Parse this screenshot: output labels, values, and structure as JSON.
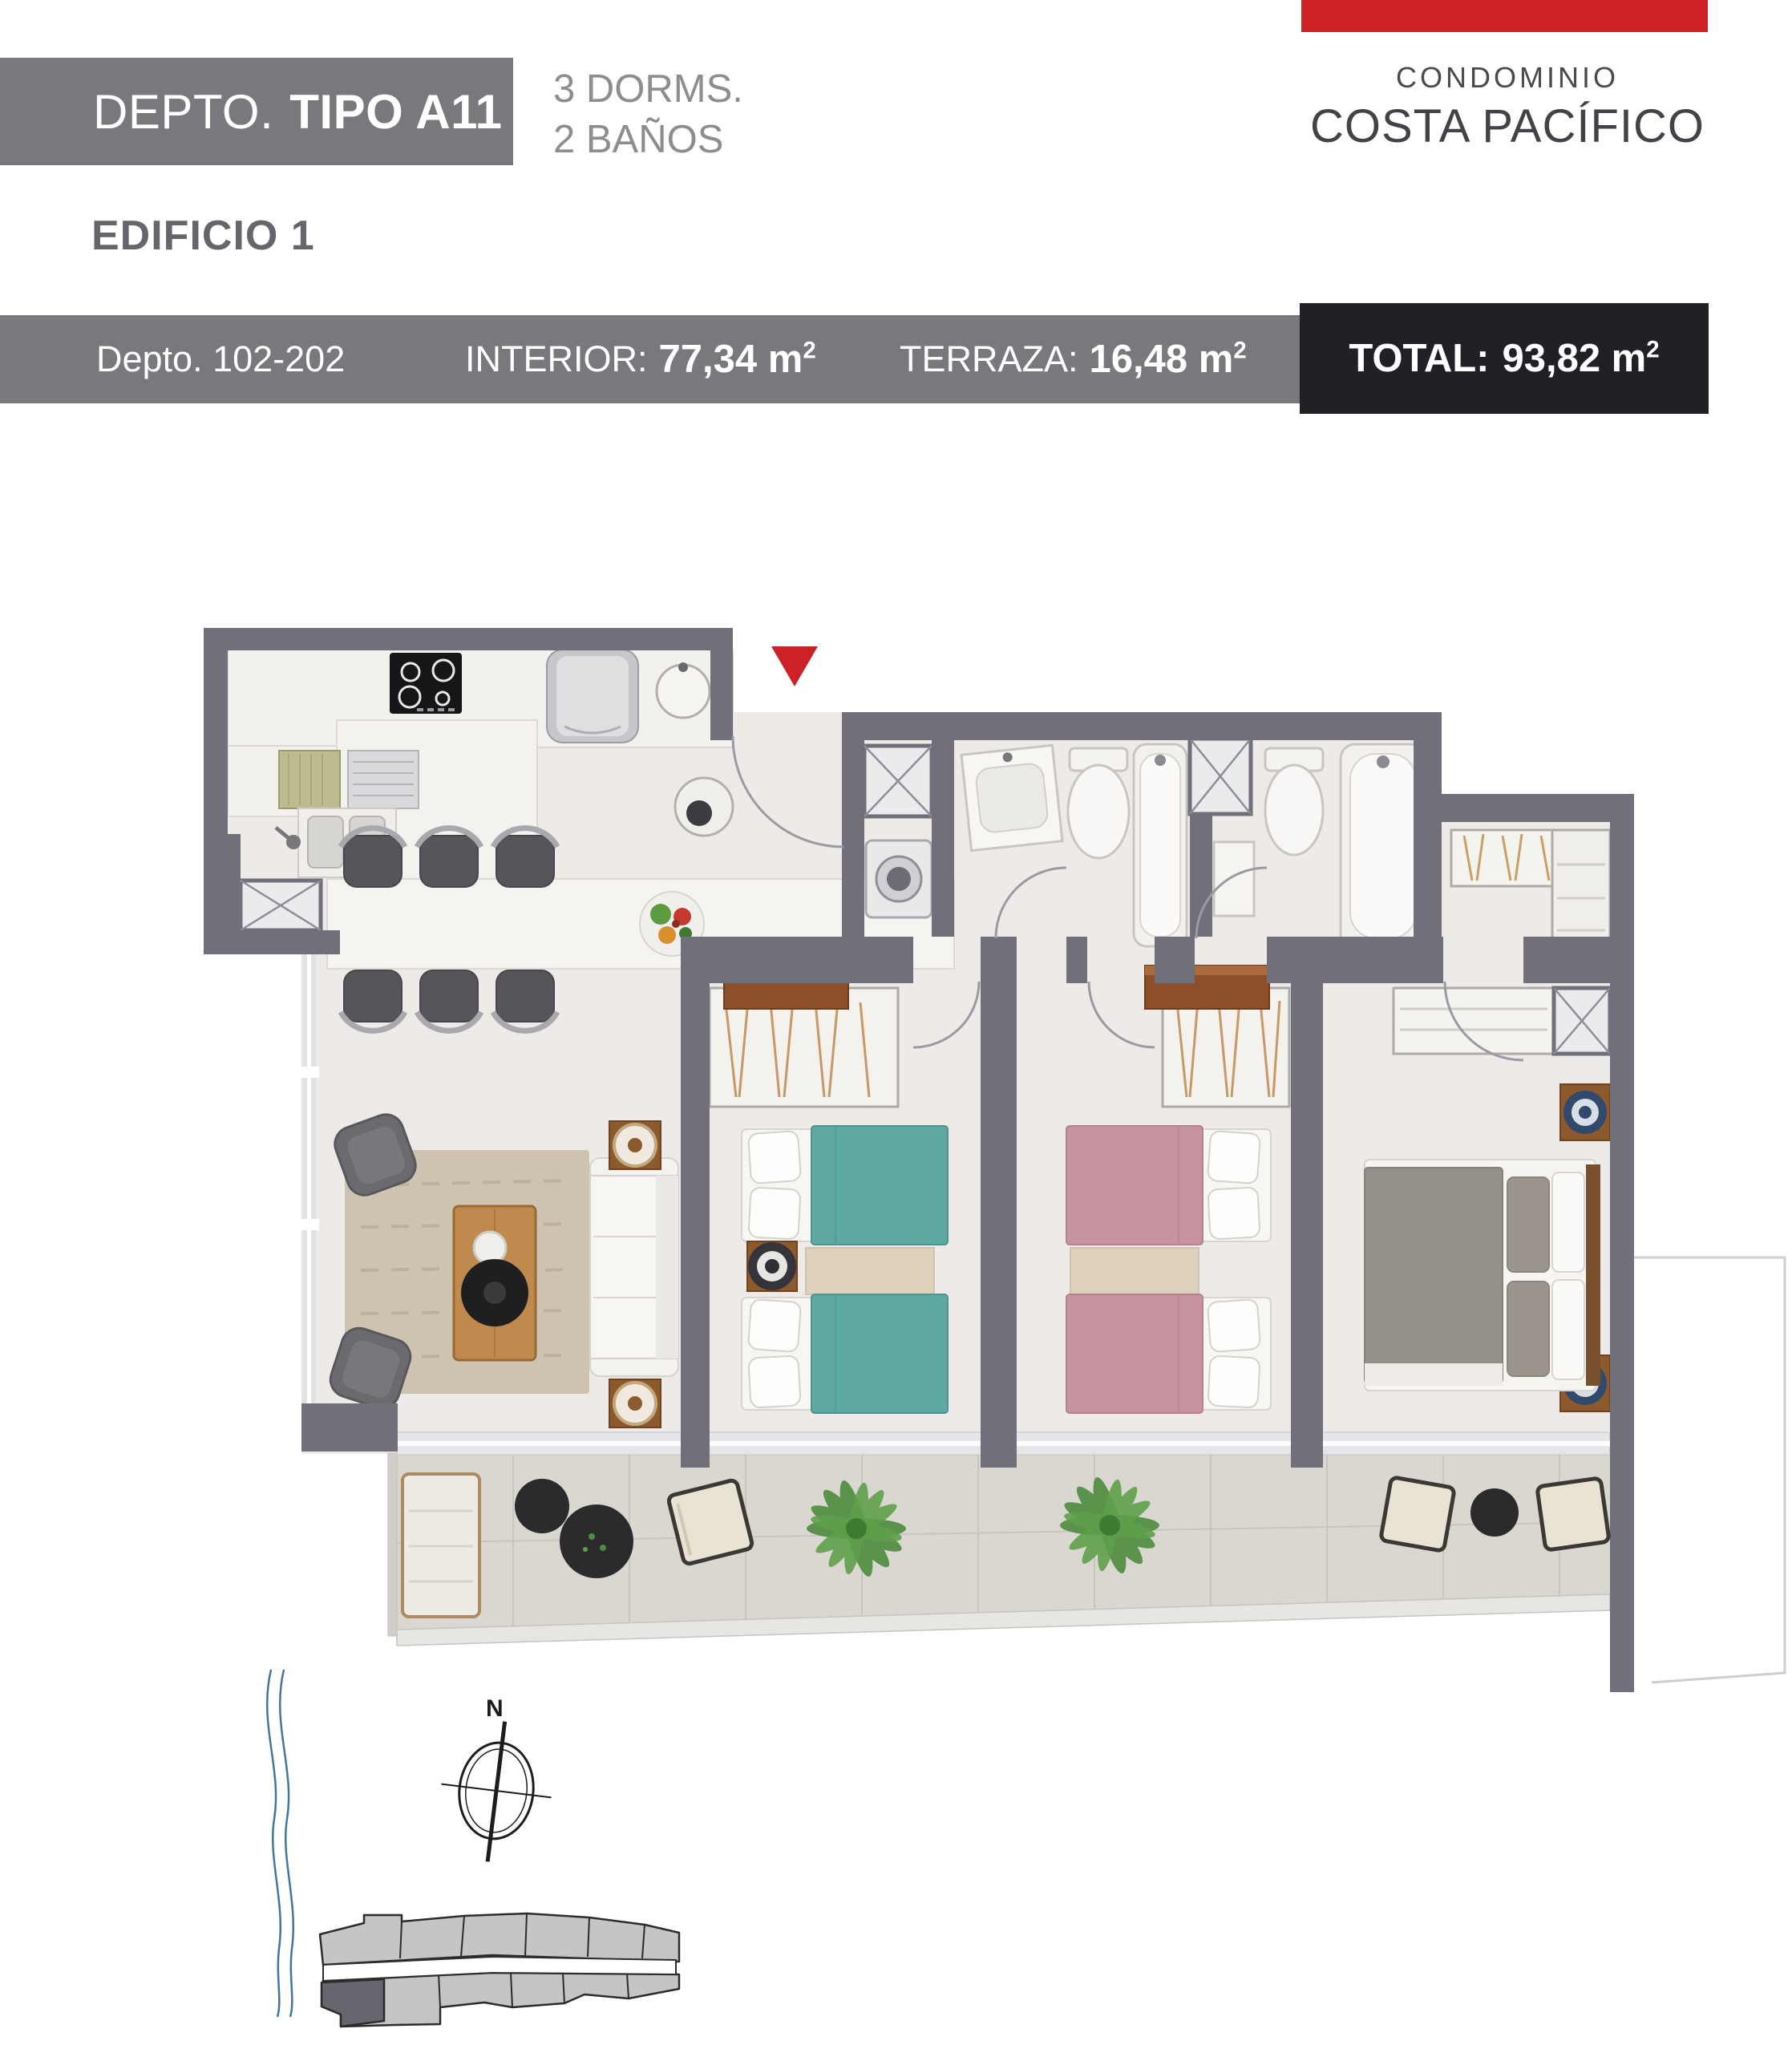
{
  "header": {
    "depto_label": "DEPTO.",
    "tipo": "TIPO A11",
    "dorms": "3 DORMS.",
    "banos": "2 BAÑOS",
    "edificio": "EDIFICIO 1",
    "condo_line1": "CONDOMINIO",
    "condo_line2": "COSTA PACÍFICO"
  },
  "info_bar": {
    "depto_range": "Depto. 102-202",
    "interior_label": "INTERIOR:",
    "interior_value": "77,34 m",
    "terraza_label": "TERRAZA:",
    "terraza_value": "16,48 m",
    "total_label": "TOTAL:",
    "total_value": "93,82 m",
    "sup": "2"
  },
  "compass": {
    "north_label": "N"
  },
  "icons": {
    "entrance_marker": "red-triangle-entrance",
    "compass": "north-compass-rose",
    "coastline": "blue-wavy-shoreline",
    "key_plan": "building-footprint-highlighted-unit"
  },
  "colors": {
    "accent_red": "#cc2127",
    "bar_gray": "#7a787d",
    "total_black": "#222026",
    "wall": "#716f79",
    "teal_bed": "#5ea9a2",
    "pink_bed": "#c793a1",
    "master_bed": "#95908a",
    "rug": "#cdc3b0",
    "terrace_floor": "#dad7d1"
  }
}
